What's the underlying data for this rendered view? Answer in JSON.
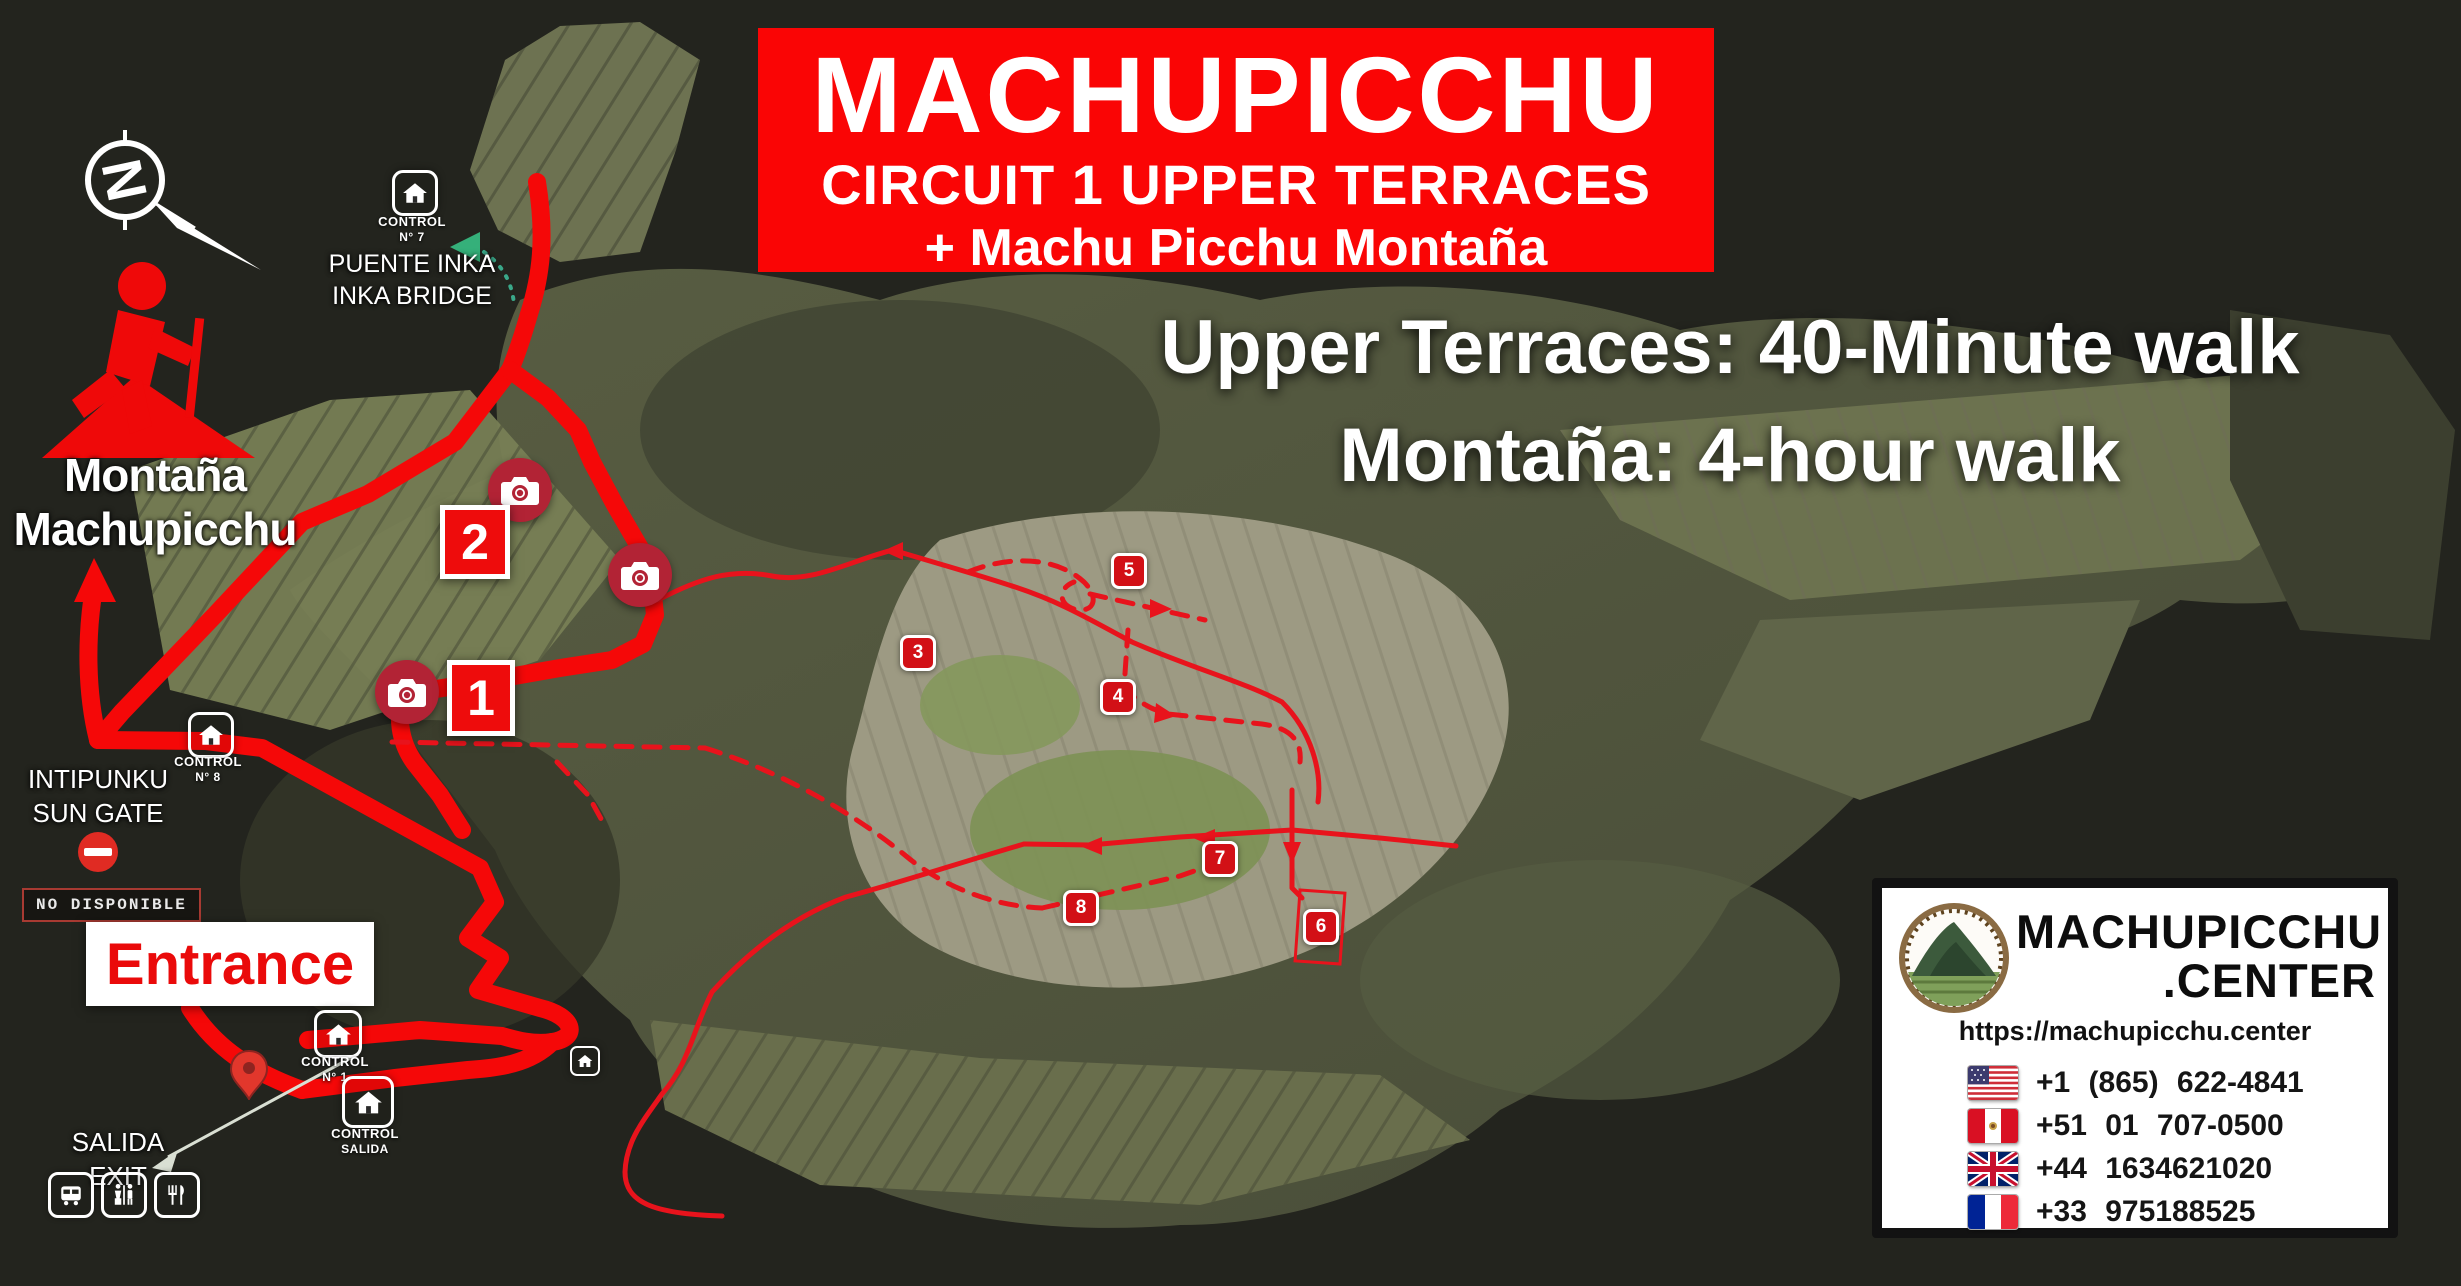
{
  "banner": {
    "title": "MACHUPICCHU",
    "subtitle": "CIRCUIT 1 UPPER TERRACES",
    "subtitle2": "+ Machu Picchu Montaña"
  },
  "walk_info": {
    "line1": "Upper Terraces: 40-Minute walk",
    "line2": "Montaña: 4-hour walk"
  },
  "compass": {
    "letter": "N"
  },
  "montana_label": {
    "line1": "Montaña",
    "line2": "Machupicchu"
  },
  "puente_inka": {
    "control_label": "CONTROL",
    "control_number": "N° 7",
    "name_es": "PUENTE INKA",
    "name_en": "INKA BRIDGE"
  },
  "intipunku": {
    "name_es": "INTIPUNKU",
    "name_en": "SUN GATE",
    "status_badge": "NO DISPONIBLE"
  },
  "controls": {
    "control8": {
      "label": "CONTROL",
      "number": "N° 8"
    },
    "control1": {
      "label": "CONTROL",
      "number": "N° 1"
    },
    "control_salida": {
      "label": "CONTROL",
      "number": "SALIDA"
    }
  },
  "entrance": {
    "label": "Entrance"
  },
  "salida_exit": {
    "line1": "SALIDA",
    "line2": "EXIT"
  },
  "route_markers": {
    "m1": "1",
    "m2": "2",
    "m3": "3",
    "m4": "4",
    "m5": "5",
    "m6": "6",
    "m7": "7",
    "m8": "8"
  },
  "info_box": {
    "brand_line1": "MACHUPICCHU",
    "brand_line2": ".CENTER",
    "url": "https://machupicchu.center",
    "phones": [
      {
        "flag": "us-flag",
        "number": "+1 (865) 622-4841"
      },
      {
        "flag": "peru-flag",
        "number": "+51 01 707-0500"
      },
      {
        "flag": "uk-flag",
        "number": "+44 1634621020"
      },
      {
        "flag": "france-flag",
        "number": "+33 975188525"
      }
    ]
  },
  "icons": {
    "compass": "compass-rose-arrow",
    "hiker": "hiker-on-mountain",
    "control": "house",
    "photo_spot": "camera",
    "no_entry": "no-entry",
    "entrance_pin": "map-pin",
    "bus": "bus",
    "restroom": "wc-figures",
    "restaurant": "fork-knife"
  },
  "colors": {
    "banner_red": "#fa0505",
    "route_red": "#f50808",
    "thin_route_red": "#e8131c",
    "marker_red": "#d21016",
    "camera_red": "#b22335",
    "map_bg": "#23241e"
  }
}
